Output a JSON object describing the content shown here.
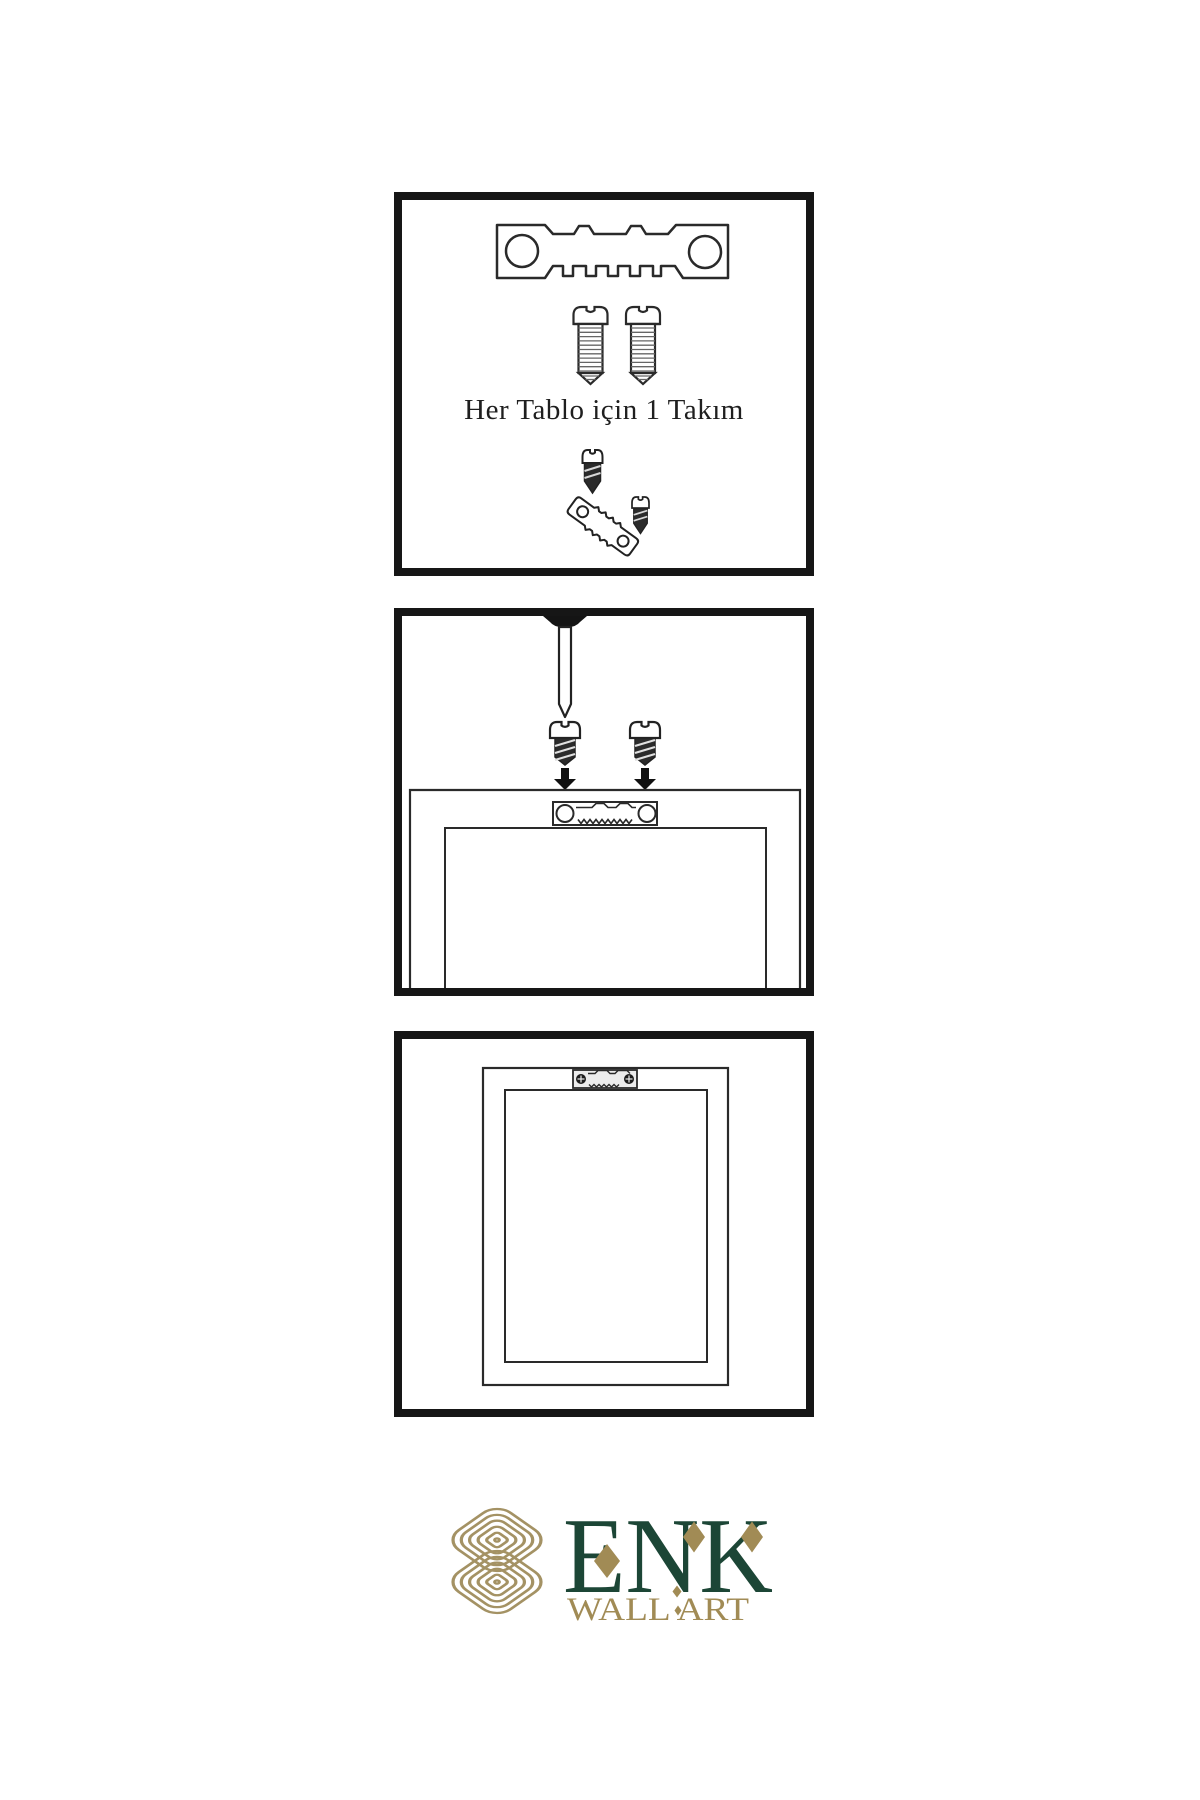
{
  "page": {
    "background_color": "#ffffff"
  },
  "diagram": {
    "line_color": "#2a2a2a",
    "panel_border_color": "#161616",
    "text_color": "#1f1f1f"
  },
  "instructions": {
    "panel1": {
      "caption": "Her Tablo için 1 Takım",
      "items": [
        "sawtooth-hanger-plate",
        "mounting-screw",
        "mounting-screw",
        "screw-into-tilted-hanger"
      ]
    },
    "panel2": {
      "items": [
        "wall-nail",
        "screw-with-down-arrow",
        "screw-with-down-arrow",
        "frame-back-with-sawtooth-hanger"
      ]
    },
    "panel3": {
      "items": [
        "hung-frame-with-mounted-hanger"
      ]
    }
  },
  "logo": {
    "brand": "ENK",
    "tagline": "WALL ART",
    "emblem": "interlocking-knot-emblem",
    "colors": {
      "brand_green": "#1c4636",
      "brand_gold": "#a18b55",
      "emblem_gold": "#a49264"
    }
  }
}
